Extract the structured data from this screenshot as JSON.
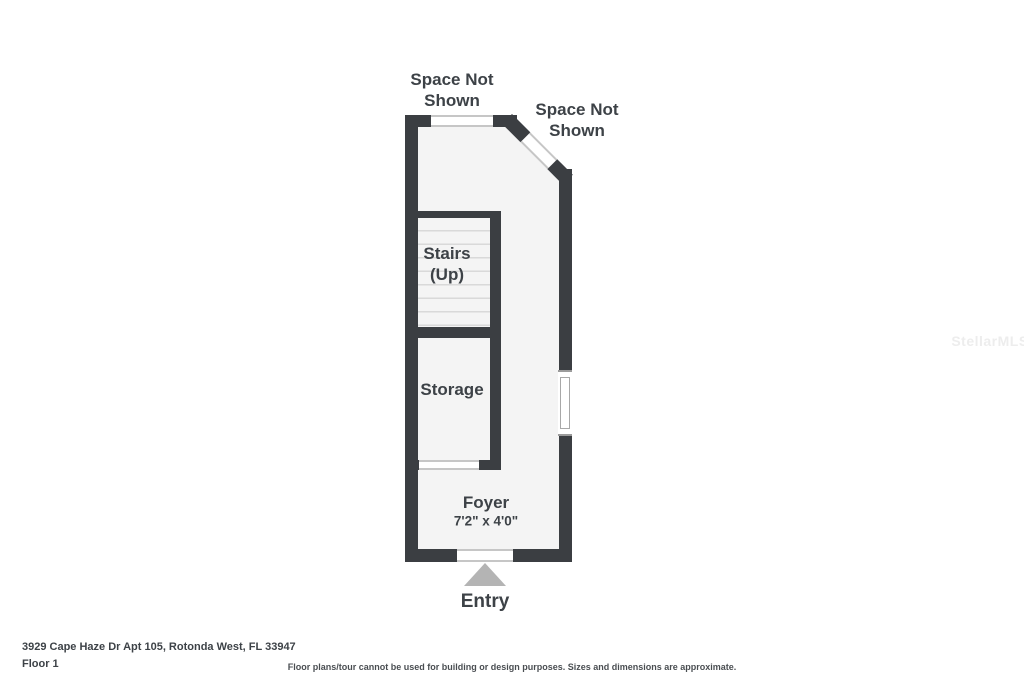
{
  "floorplan": {
    "labels": {
      "space_not_shown_top": "Space Not Shown",
      "space_not_shown_right": "Space Not Shown",
      "stairs_line1": "Stairs",
      "stairs_line2": "(Up)",
      "storage": "Storage",
      "foyer": "Foyer",
      "foyer_dimensions": "7'2\" x 4'0\"",
      "entry": "Entry"
    },
    "colors": {
      "wall": "#3b3e42",
      "floor": "#f4f4f4",
      "opening_line": "#c6c6c6",
      "tread_line": "#d9d9d9",
      "text": "#3d4247",
      "entry_arrow": "#b4b4b4",
      "watermark": "#ededed"
    }
  },
  "footer": {
    "address": "3929 Cape Haze Dr Apt 105, Rotonda West, FL 33947",
    "floor_label": "Floor 1",
    "disclaimer": "Floor plans/tour cannot be used for building or design purposes. Sizes and dimensions are approximate."
  },
  "watermark": "StellarMLS"
}
